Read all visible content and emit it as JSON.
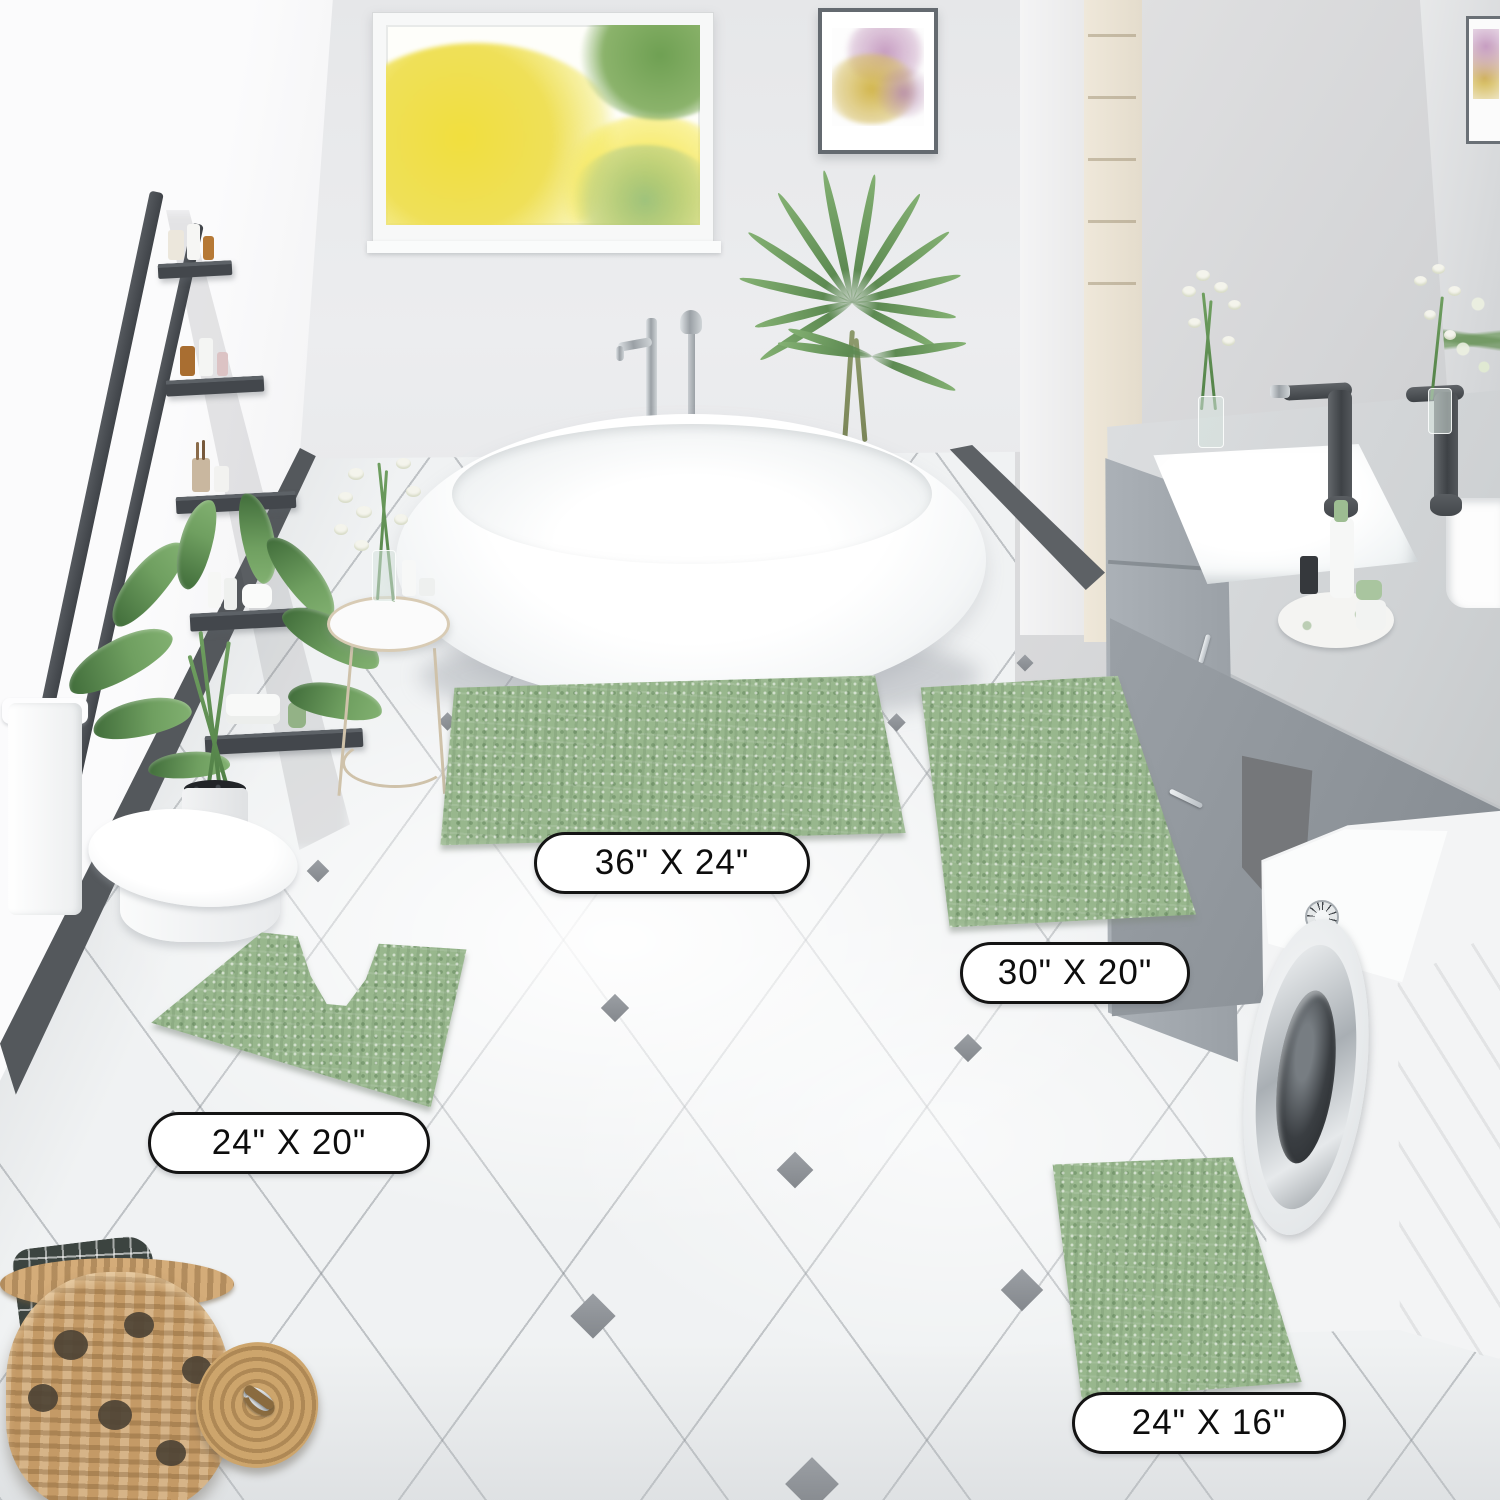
{
  "product_labels": {
    "rug_large": "36\" X 24\"",
    "rug_runner": "30\" X 20\"",
    "rug_contour": "24\" X 20\"",
    "rug_small": "24\" X 16\""
  },
  "colors": {
    "rug_green": "#98b78d",
    "floor_tile": "#f0f2f3",
    "tile_accent_diamond": "#8d9196",
    "wall_left": "#f6f6f7",
    "wall_back": "#e9eaec",
    "wall_right": "#d2d4d6",
    "ladder_shelf": "#4b4f54",
    "vanity_gray": "#a3a9af",
    "basket_tan": "#c49a66",
    "label_border": "#141414",
    "label_background": "#ffffff"
  }
}
